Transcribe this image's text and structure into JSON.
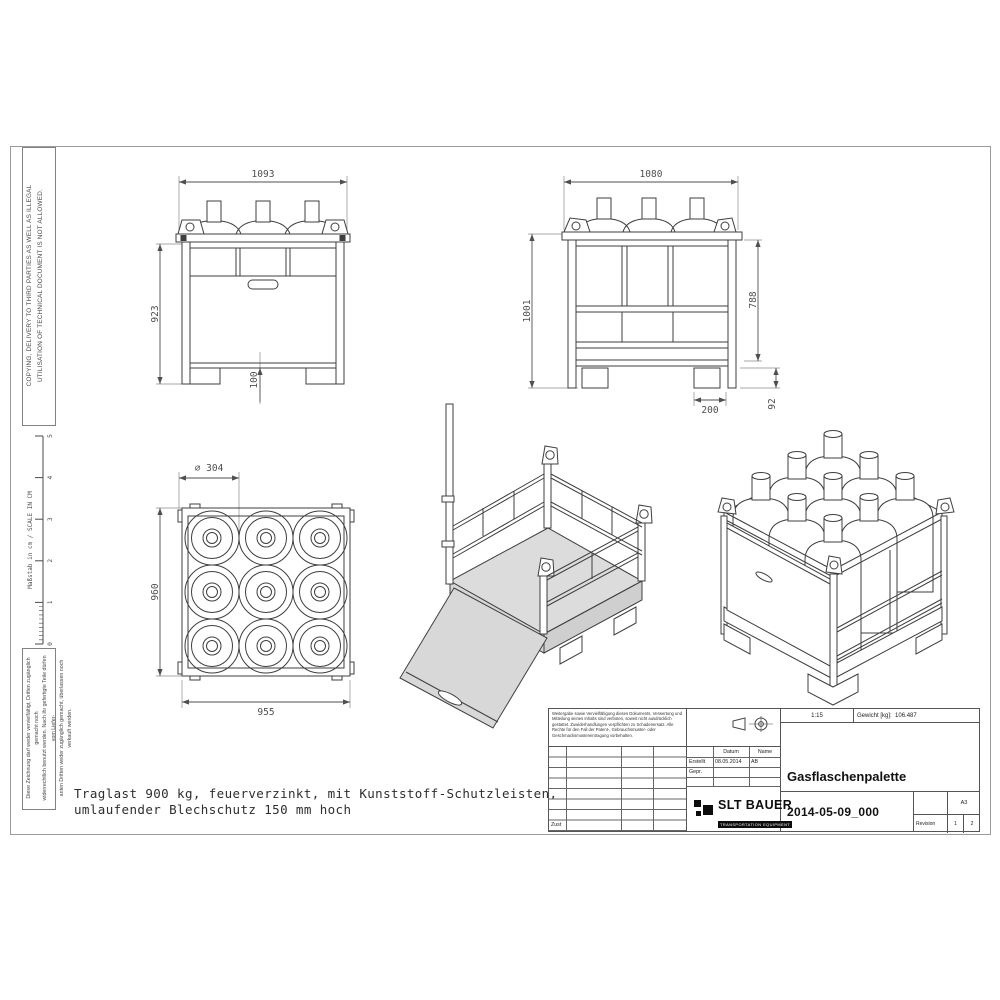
{
  "colors": {
    "line": "#3f3f3f",
    "dim_text": "#4f4f4f",
    "light_fill": "#d9d9d9",
    "mid_fill": "#cfcfcf",
    "sheet_border": "#9b9b9b"
  },
  "border": {
    "notice_top": {
      "line1": "COPYING, DELIVERY TO THIRD PARTIES AS WELL AS ILLEGAL",
      "line2": "UTILISATION OF TECHNICAL DOCUMENT IS NOT ALLOWED."
    },
    "ruler": {
      "label": "Maßstab in cm / SCALE IN CM",
      "ticks": [
        "0",
        "1",
        "2",
        "3",
        "4",
        "5"
      ]
    },
    "notice_bottom": {
      "line1": "Diese Zeichnung darf weder vervielfältigt, Dritten zugänglich gemacht noch",
      "line2": "widerrechtlich benutzt werden. Nach ihr gefertigte Teile dürfen vom Liefer-",
      "line3": "anten Dritten weder zugänglich gemacht, überlassen noch verkauft werden."
    }
  },
  "views": {
    "front": {
      "dim_width": "1093",
      "dim_height": "923",
      "dim_foot": "100"
    },
    "side": {
      "dim_width": "1080",
      "dim_height_total": "1001",
      "dim_height_frame": "788",
      "dim_foot_depth": "200",
      "dim_foot_height": "92"
    },
    "top": {
      "dim_diameter": "⌀ 304",
      "dim_height": "960",
      "dim_width": "955"
    }
  },
  "note": {
    "line1": "Traglast 900 kg, feuerverzinkt, mit Kunststoff-Schutzleisten,",
    "line2": "umlaufender Blechschutz 150 mm hoch"
  },
  "title_block": {
    "disclaimer": "Weitergabe sowie Vervielfältigung dieses Dokuments, Verwertung und Mitteilung seines Inhalts sind verboten, soweit nicht ausdrücklich gestattet. Zuwiderhandlungen verpflichten zu Schadenersatz. Alle Rechte für den Fall der Patent-, Gebrauchsmuster- oder Geschmacksmustereintragung vorbehalten.",
    "zust_label": "Zust",
    "approval": {
      "col_date": "Datum",
      "col_name": "Name",
      "created_label": "Erstellt",
      "created_date": "08.05.2014",
      "created_name": "AB",
      "checked_label": "Gepr."
    },
    "scale": "1:15",
    "weight_label": "Gewicht [kg]:",
    "weight_value": "106.487",
    "title": "Gasflaschenpalette",
    "drawing_number": "2014-05-09_000",
    "format": "A3",
    "revision_label": "Revision",
    "sheet_current": "1",
    "sheet_total": "2",
    "company": {
      "name": "SLT BAUER",
      "tagline": "TRANSPORTATION EQUIPMENT"
    }
  }
}
